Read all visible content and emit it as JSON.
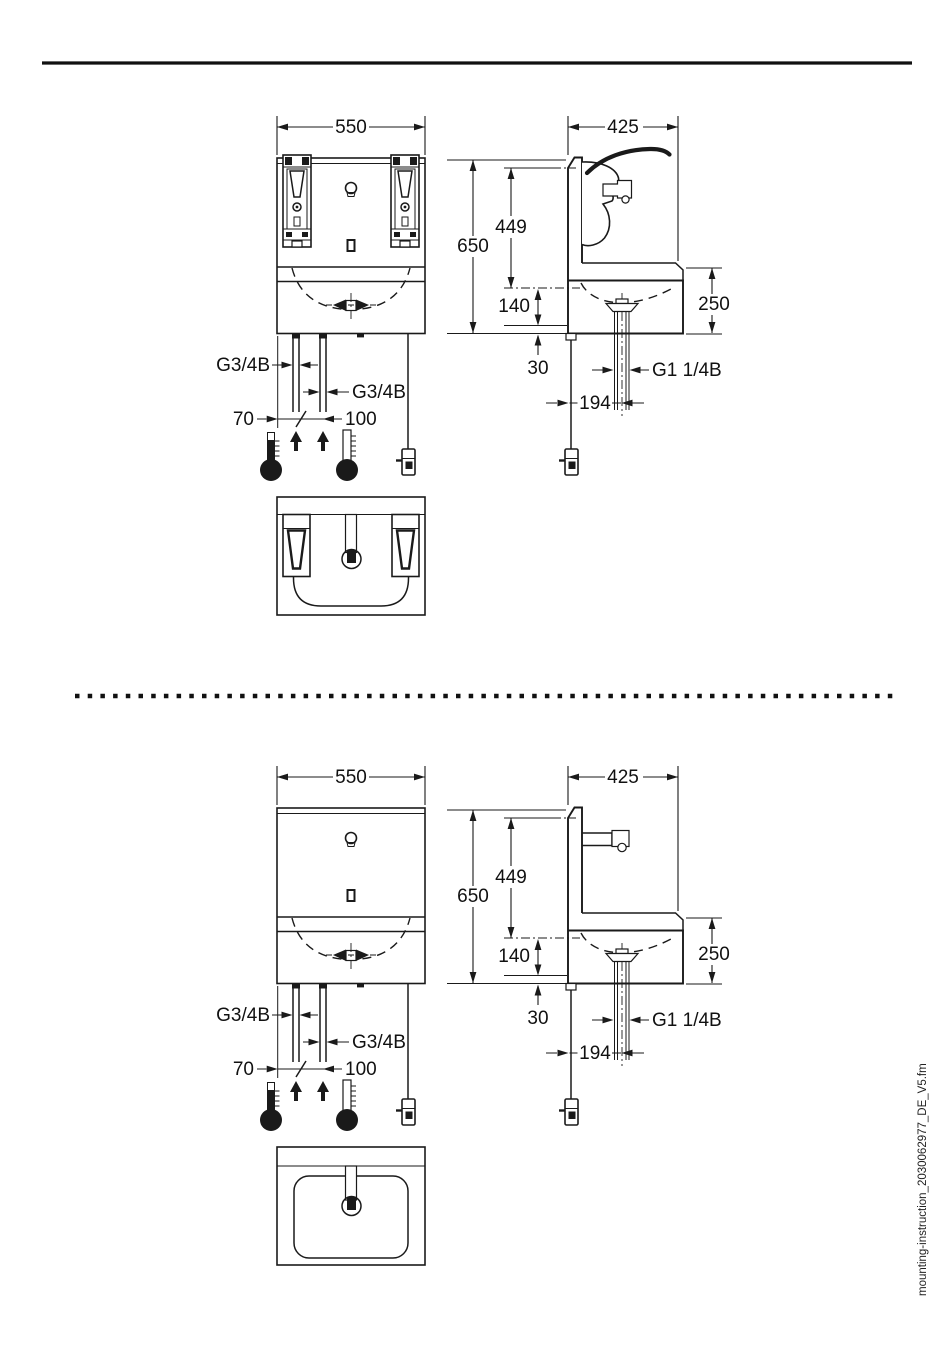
{
  "document": {
    "sidebar_filename": "mounting-instruction_2030062977_DE_V5.fm"
  },
  "figure_top": {
    "dims": {
      "width": "550",
      "depth": "425",
      "height": "650",
      "spout_height": "449",
      "basin_depth": "140",
      "apron_height": "250",
      "bottom_offset": "30",
      "drain_offset": "194"
    },
    "threads": {
      "supply_left": "G3/4B",
      "supply_right": "G3/4B",
      "drain": "G1 1/4B"
    },
    "spacing": {
      "edge_to_pipe": "70",
      "pipe_to_pipe": "100"
    }
  },
  "figure_bottom": {
    "dims": {
      "width": "550",
      "depth": "425",
      "height": "650",
      "spout_height": "449",
      "basin_depth": "140",
      "apron_height": "250",
      "bottom_offset": "30",
      "drain_offset": "194"
    },
    "threads": {
      "supply_left": "G3/4B",
      "supply_right": "G3/4B",
      "drain": "G1 1/4B"
    },
    "spacing": {
      "edge_to_pipe": "70",
      "pipe_to_pipe": "100"
    }
  }
}
